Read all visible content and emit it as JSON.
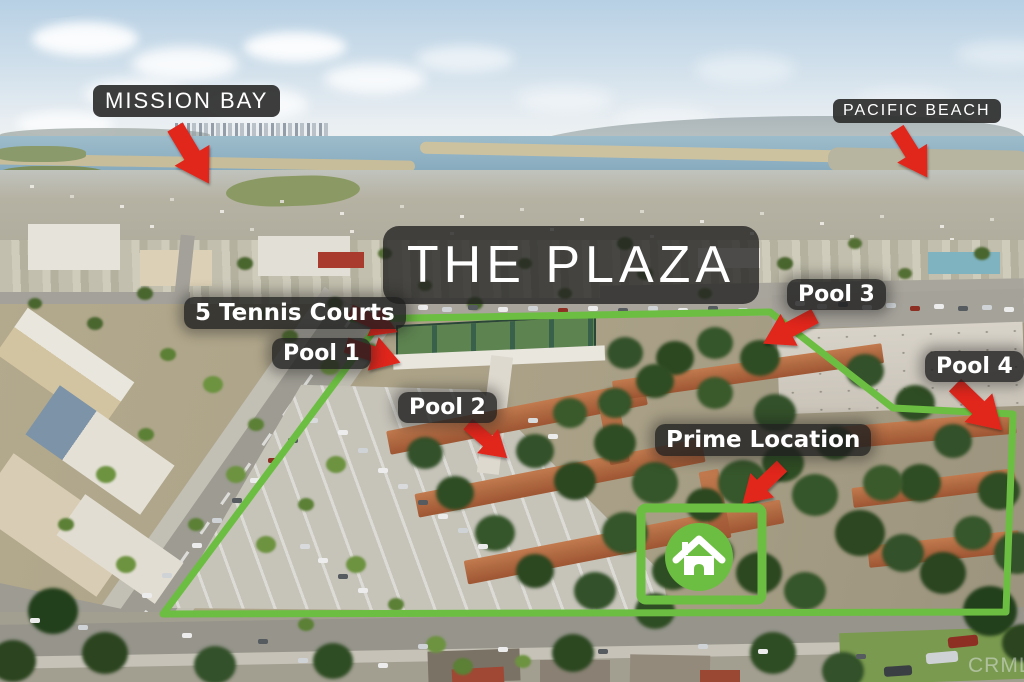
{
  "labels": {
    "mission_bay": "MISSION BAY",
    "pacific_beach": "PACIFIC BEACH",
    "title": "THE PLAZA",
    "tennis": "5 Tennis Courts",
    "pool1": "Pool 1",
    "pool2": "Pool 2",
    "pool3": "Pool 3",
    "pool4": "Pool 4",
    "prime_location": "Prime Location",
    "watermark": "CRMLS"
  },
  "colors": {
    "boundary_green": "#6cbe42",
    "arrow_red": "#e1251b",
    "label_background": "#2d2d2d",
    "label_text": "#ffffff"
  },
  "marker": {
    "icon": "home-icon",
    "shape": "green circle with white house inside green rectangle outline"
  }
}
